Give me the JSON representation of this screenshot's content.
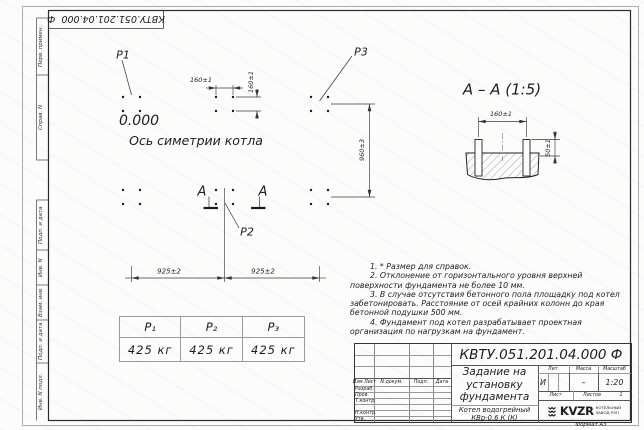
{
  "doc": {
    "number": "КВТУ.051.201.04.000  Ф",
    "format": "Формат А3"
  },
  "sidebar": {
    "cells": [
      "Перв. примен.",
      "Справ. N",
      "Подп. и дата",
      "Инв. N дубл.",
      "Взам. инв. N",
      "Подп. и дата",
      "Инв. N подл."
    ]
  },
  "plan": {
    "elevation": "0.000",
    "axis_label": "Ось симетрии котла",
    "p1": "Р1",
    "p2": "Р2",
    "p3": "Р3",
    "section_letter": "А",
    "dim_160_h": "160±1",
    "dim_160_v": "160±1",
    "dim_925_left": "925±2",
    "dim_925_right": "925±2",
    "dim_960": "960±3"
  },
  "section_view": {
    "title": "А – А (1:5)",
    "dim_160": "160±1",
    "dim_50": "50±1"
  },
  "load_table": {
    "headers": [
      "Р₁",
      "Р₂",
      "Р₃"
    ],
    "values": [
      "425 кг",
      "425 кг",
      "425 кг"
    ]
  },
  "notes": [
    "1. * Размер для справок.",
    "2. Отклонение от горизонтального уровня верхней поверхности фундамента не более 10 мм.",
    "3. В случае отсутствия бетонного пола площадку под котел забетонировать. Расстояние от осей крайних колонн до края бетонной подушки 500 мм.",
    "4. Фундамент под котел разрабатывает проектная организация по нагрузкам на фундамент."
  ],
  "title_block": {
    "doc_number": "КВТУ.051.201.04.000  Ф",
    "title": "Задание на установку фундамента",
    "product": "Котел водогрейный КВр-0,6 К (К)",
    "sign_headers": [
      "Изм.Лист",
      "N докум.",
      "Подп.",
      "Дата"
    ],
    "sign_rows": [
      "Разраб.",
      "Пров.",
      "Т.контр.",
      "Н.контр.",
      "Утв."
    ],
    "headers": {
      "lit": "Лит.",
      "mass": "Масса",
      "scale": "Масштаб",
      "sheet": "Лист",
      "sheets": "Листов"
    },
    "values": {
      "lit": "И",
      "mass": "–",
      "scale": "1:20",
      "sheets_total": "1"
    },
    "company": {
      "logo": "KVZR",
      "name_line1": "КОТЕЛЬНЫЙ",
      "name_line2": "ЗАВОД РЭП"
    }
  }
}
